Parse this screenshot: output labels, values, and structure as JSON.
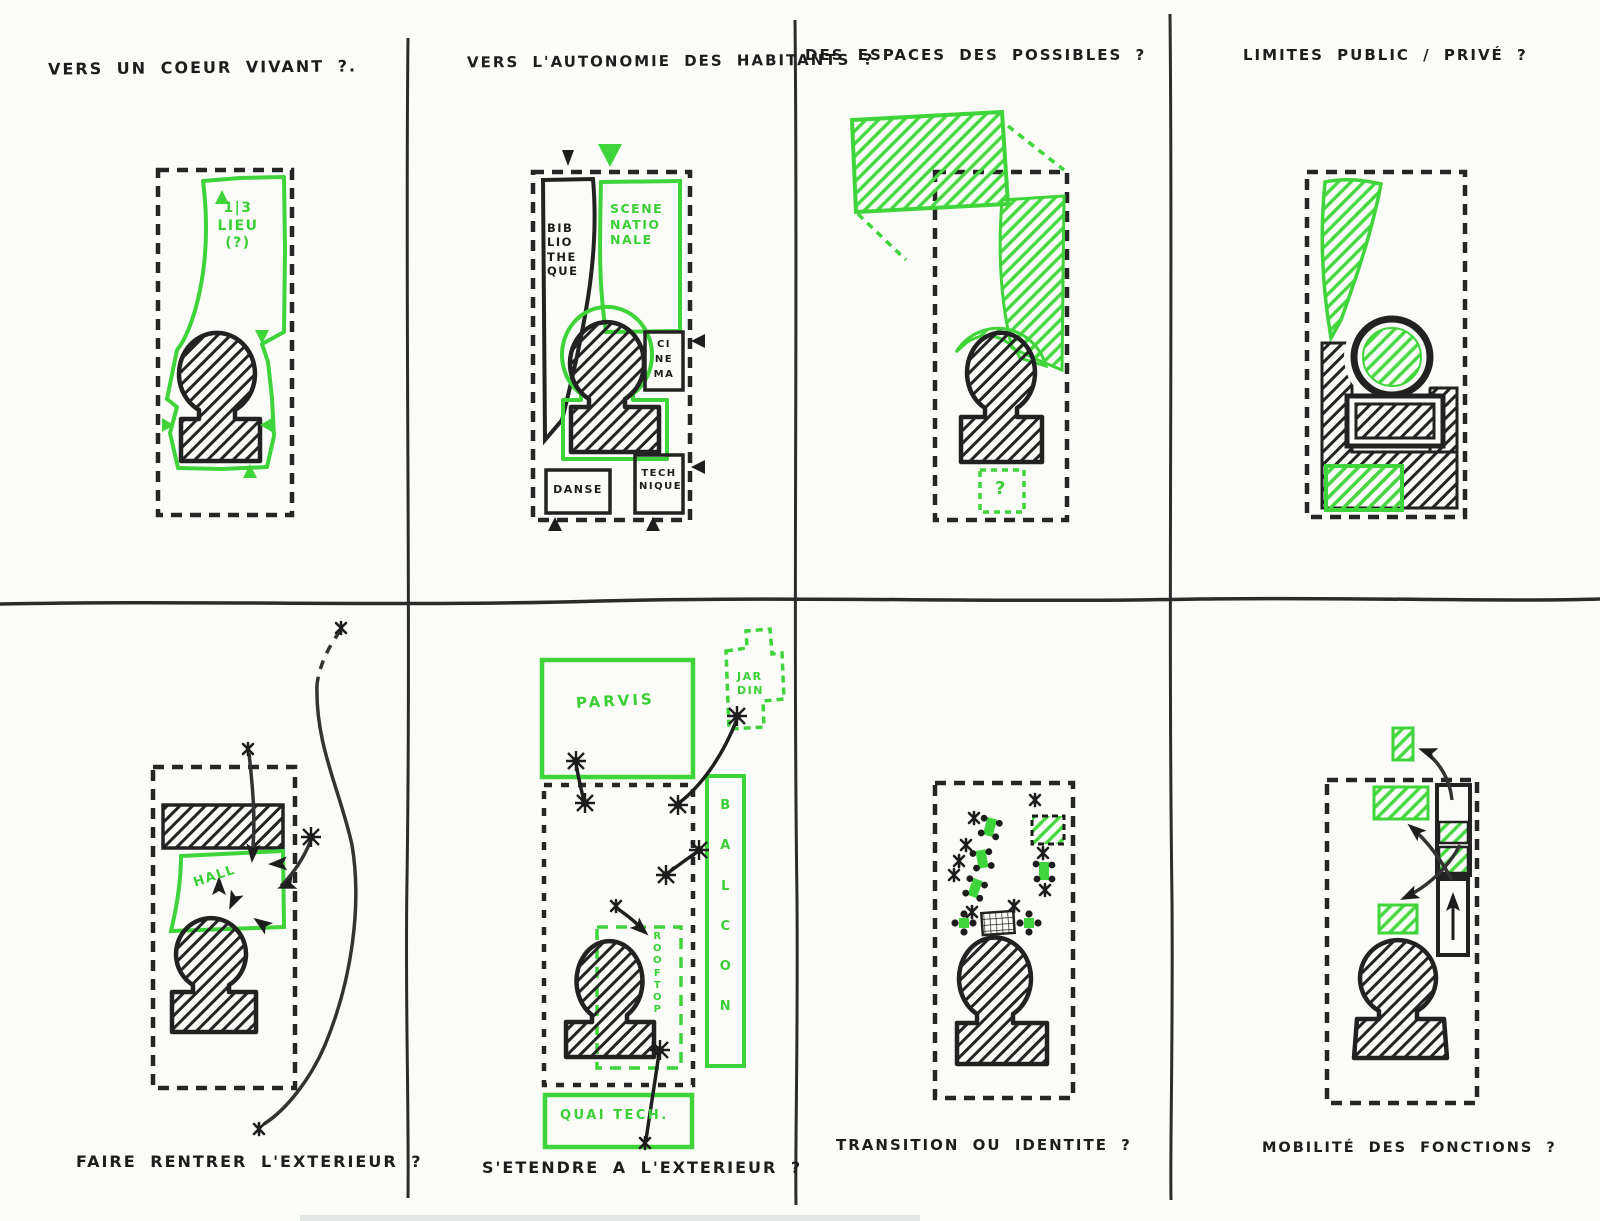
{
  "palette": {
    "paper": "#fbfbf8",
    "ink_black": "#1d1d1d",
    "marker_green": "#3fd43a"
  },
  "panels": [
    {
      "id": "coeur-vivant",
      "title": "VERS UN COEUR VIVANT ?.",
      "labels": {
        "tiers_lieu": "1|3\nLIEU\n(?)"
      }
    },
    {
      "id": "autonomie-habitants",
      "title": "VERS L'AUTONOMIE DES HABITANTS ?",
      "labels": {
        "bibliotheque": "BIB\nLIO\nTHE\nQUE",
        "scene_nationale": "SCENE\nNATIO\nNALE",
        "cinema": "CI\nNE\nMA",
        "danse": "DANSE",
        "technique": "TECH\nNIQUE"
      }
    },
    {
      "id": "espaces-possibles",
      "title": "DES ESPACES DES POSSIBLES ?",
      "labels": {
        "question": "?"
      }
    },
    {
      "id": "limites-public-prive",
      "title": "LIMITES PUBLIC / PRIVÉ ?",
      "labels": {}
    },
    {
      "id": "faire-rentrer-exterieur",
      "title": "FAIRE RENTRER L'EXTERIEUR ?",
      "labels": {
        "hall": "HALL"
      }
    },
    {
      "id": "etendre-exterieur",
      "title": "S'ETENDRE A L'EXTERIEUR ?",
      "labels": {
        "parvis": "PARVIS",
        "jardin": "JAR\nDIN",
        "balcon": "B\nA\nL\nC\nO\nN",
        "rooftop": "R\nO\nO\nF\nT\nO\nP",
        "quai_tech": "QUAI TECH."
      }
    },
    {
      "id": "transition-identite",
      "title": "TRANSITION OU IDENTITE ?",
      "labels": {}
    },
    {
      "id": "mobilite-fonctions",
      "title": "MOBILITÉ DES FONCTIONS ?",
      "labels": {}
    }
  ]
}
